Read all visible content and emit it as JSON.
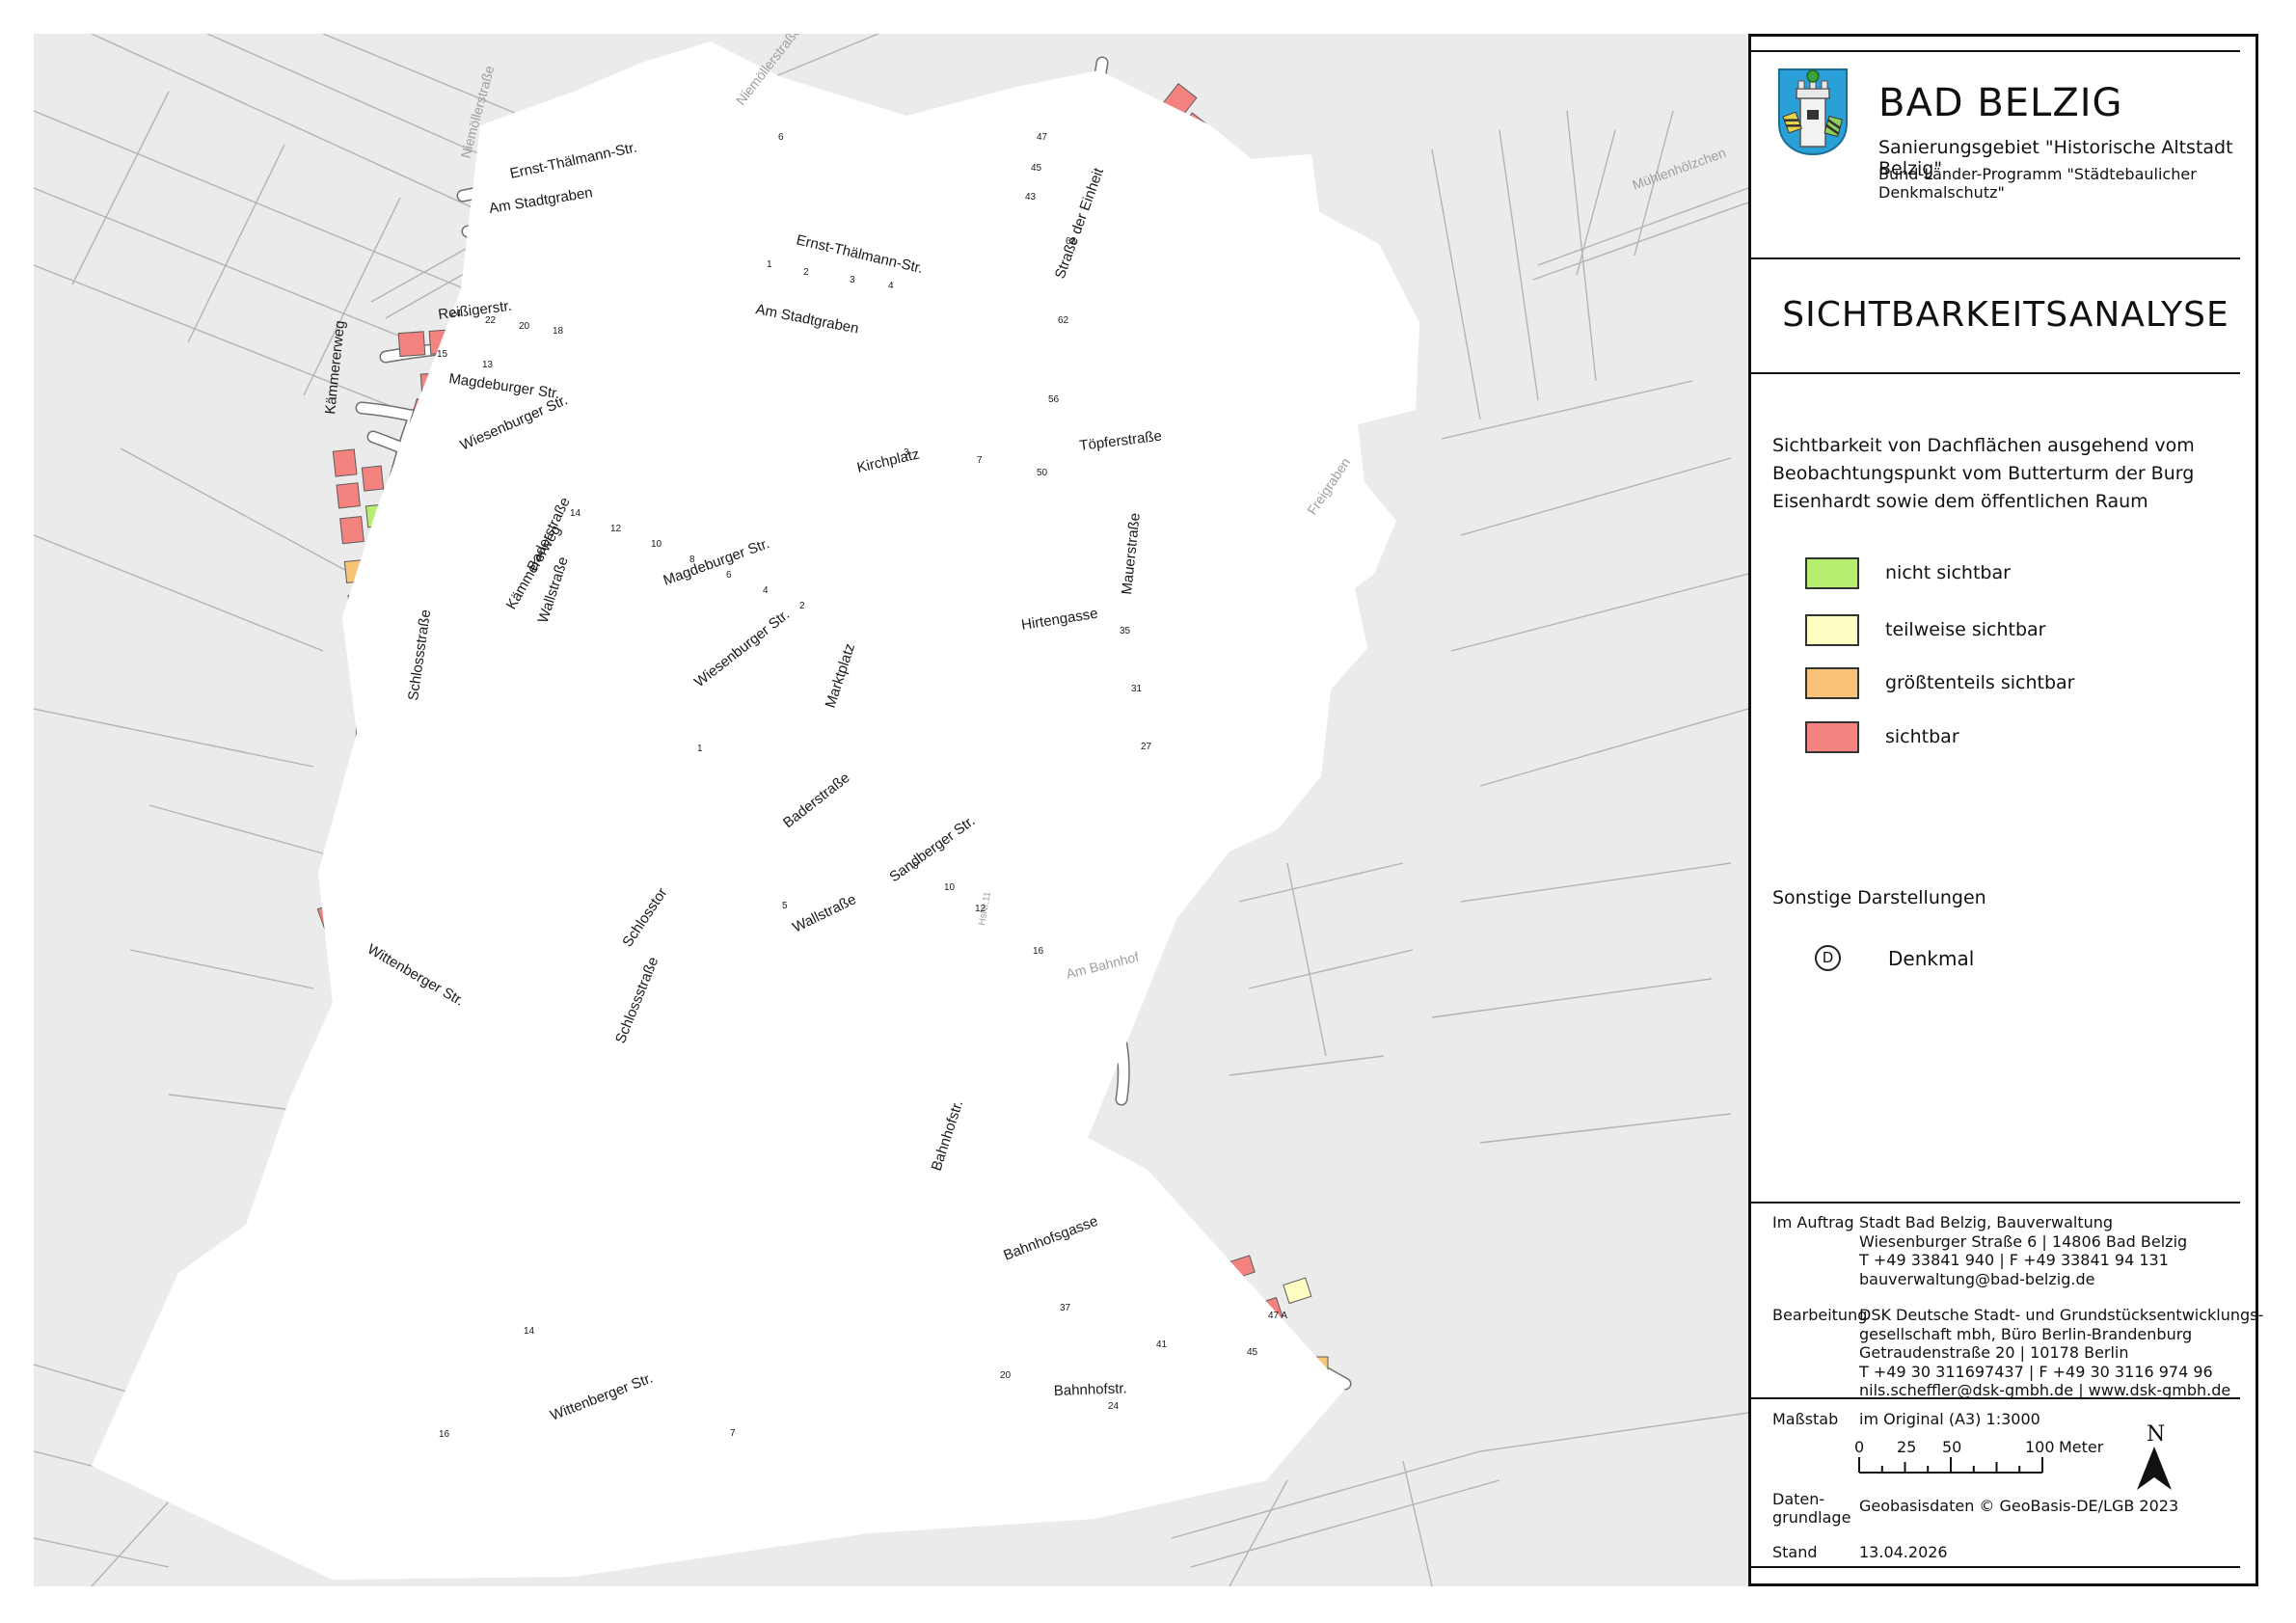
{
  "panel": {
    "org": "BAD BELZIG",
    "subtitle1": "Sanierungsgebiet \"Historische Altstadt Belzig\"",
    "subtitle2": "Bund-Länder-Programm \"Städtebaulicher Denkmalschutz\"",
    "title": "SICHTBARKEITSANALYSE",
    "description": "Sichtbarkeit von Dachflächen ausgehend vom Beobachtungspunkt vom Butterturm der Burg Eisenhardt sowie dem öffentlichen Raum",
    "legend": {
      "items": [
        {
          "label": "nicht sichtbar",
          "color": "#b6ef70"
        },
        {
          "label": "teilweise sichtbar",
          "color": "#ffffc4"
        },
        {
          "label": "größtenteils sichtbar",
          "color": "#f9c477"
        },
        {
          "label": "sichtbar",
          "color": "#f4827e"
        }
      ]
    },
    "other_heading": "Sonstige Darstellungen",
    "denkmal": {
      "symbol": "D",
      "label": "Denkmal"
    },
    "credits": [
      {
        "label": "Im Auftrag",
        "lines": "Stadt Bad Belzig, Bauverwaltung\nWiesenburger Straße 6 | 14806 Bad Belzig\nT +49 33841 940 | F +49 33841 94 131\nbauverwaltung@bad-belzig.de"
      },
      {
        "label": "Bearbeitung",
        "lines": "DSK Deutsche Stadt- und Grundstücksentwicklungs-\ngesellschaft mbh, Büro Berlin-Brandenburg\nGetraudenstraße 20 | 10178 Berlin\nT +49 30 311697437 | F +49 30 3116 974 96\nnils.scheffler@dsk-gmbh.de | www.dsk-gmbh.de"
      }
    ],
    "scale": {
      "label": "Maßstab",
      "value": "im Original (A3) 1:3000",
      "ticks": [
        "0",
        "25",
        "50",
        "100"
      ],
      "unit": "Meter"
    },
    "north": "N",
    "basis": {
      "label": "Daten-\ngrundlage",
      "value": "Geobasisdaten © GeoBasis-DE/LGB 2023"
    },
    "stand": {
      "label": "Stand",
      "value": "13.04.2026"
    }
  },
  "map": {
    "streets": [
      {
        "name": "Niemöllerstraße"
      },
      {
        "name": "Niemöllerstraße"
      },
      {
        "name": "Ernst-Thälmann-Str."
      },
      {
        "name": "Ernst-Thälmann-Str."
      },
      {
        "name": "Am Stadtgraben"
      },
      {
        "name": "Am Stadtgraben"
      },
      {
        "name": "Straße der Einheit"
      },
      {
        "name": "Töpferstraße"
      },
      {
        "name": "Kirchplatz"
      },
      {
        "name": "Reißigerstr."
      },
      {
        "name": "Magdeburger Str."
      },
      {
        "name": "Magdeburger Str."
      },
      {
        "name": "Hirtengasse"
      },
      {
        "name": "Mauerstraße"
      },
      {
        "name": "Wiesenburger Str."
      },
      {
        "name": "Wiesenburger Str."
      },
      {
        "name": "Marktplatz"
      },
      {
        "name": "Baderstraße"
      },
      {
        "name": "Baderstraße"
      },
      {
        "name": "Sandberger Str."
      },
      {
        "name": "Wallstraße"
      },
      {
        "name": "Wallstraße"
      },
      {
        "name": "Schlosstor"
      },
      {
        "name": "Schlossstraße"
      },
      {
        "name": "Schlossstraße"
      },
      {
        "name": "Kämmererweg"
      },
      {
        "name": "Kämmererweg"
      },
      {
        "name": "Bahnhofstr."
      },
      {
        "name": "Bahnhofstr."
      },
      {
        "name": "Bahnhofsgasse"
      },
      {
        "name": "Wittenberger Str."
      },
      {
        "name": "Wittenberger Str."
      },
      {
        "name": "Freigraben"
      },
      {
        "name": "Mühlenhölzchen"
      },
      {
        "name": "Am Bahnhof"
      },
      {
        "name": "HsNr.11"
      }
    ],
    "house_numbers": [
      {
        "t": "47"
      },
      {
        "t": "45"
      },
      {
        "t": "43"
      },
      {
        "t": "68"
      },
      {
        "t": "62"
      },
      {
        "t": "56"
      },
      {
        "t": "50"
      },
      {
        "t": "6"
      },
      {
        "t": "1"
      },
      {
        "t": "2"
      },
      {
        "t": "3"
      },
      {
        "t": "4"
      },
      {
        "t": "24"
      },
      {
        "t": "22"
      },
      {
        "t": "20"
      },
      {
        "t": "18"
      },
      {
        "t": "15"
      },
      {
        "t": "13"
      },
      {
        "t": "3"
      },
      {
        "t": "7"
      },
      {
        "t": "14"
      },
      {
        "t": "12"
      },
      {
        "t": "10"
      },
      {
        "t": "8"
      },
      {
        "t": "6"
      },
      {
        "t": "4"
      },
      {
        "t": "2"
      },
      {
        "t": "35"
      },
      {
        "t": "31"
      },
      {
        "t": "27"
      },
      {
        "t": "8"
      },
      {
        "t": "10"
      },
      {
        "t": "12"
      },
      {
        "t": "16"
      },
      {
        "t": "1"
      },
      {
        "t": "5"
      },
      {
        "t": "14"
      },
      {
        "t": "16"
      },
      {
        "t": "20"
      },
      {
        "t": "24"
      },
      {
        "t": "37"
      },
      {
        "t": "41"
      },
      {
        "t": "45"
      },
      {
        "t": "47 A"
      },
      {
        "t": "7"
      }
    ]
  }
}
